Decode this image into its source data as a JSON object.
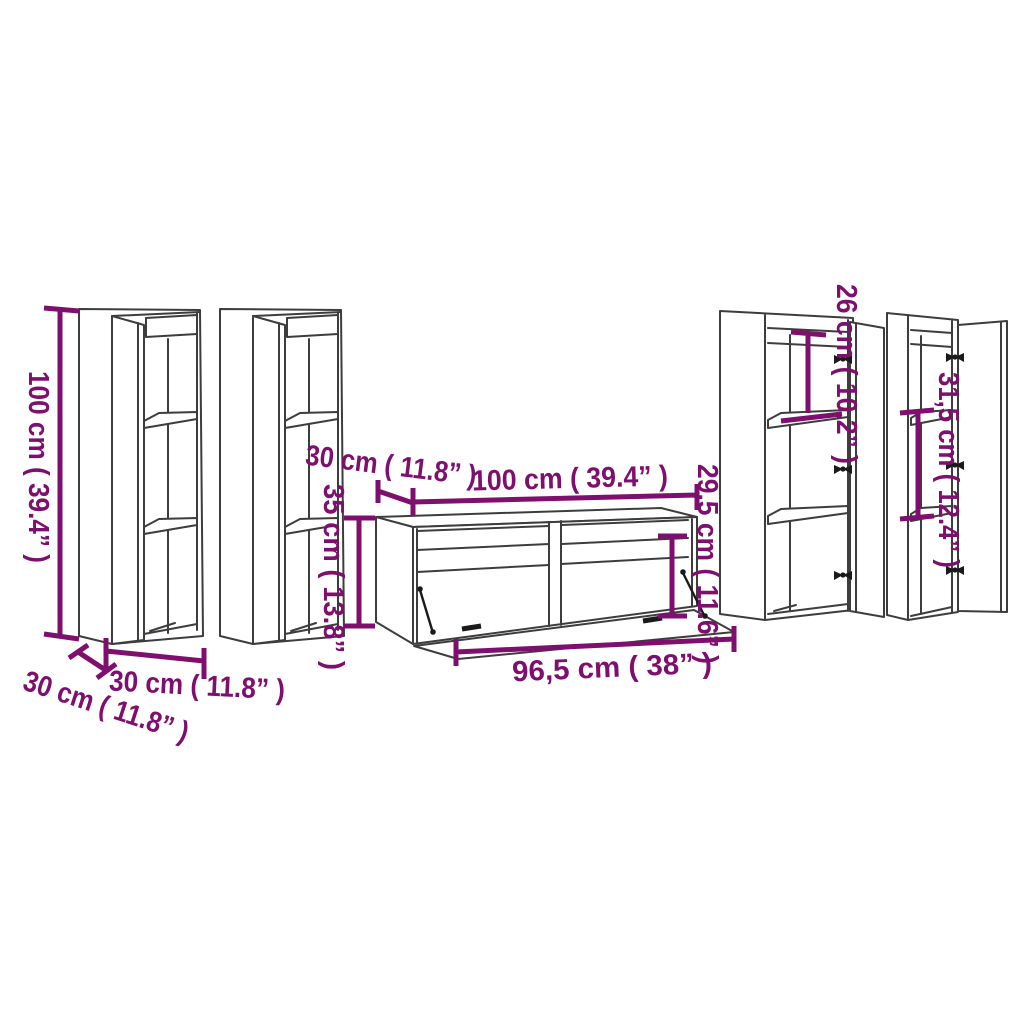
{
  "colors": {
    "accent": "#7e0f6e",
    "line": "#3d3d3d",
    "background": "#ffffff",
    "hardware": "#1a1a1a"
  },
  "figure": {
    "type": "furniture-dimension-diagram",
    "pieces": [
      "tall-wall-cabinet",
      "tall-wall-cabinet",
      "tv-stand-with-flap-door",
      "wall-cabinet-with-door",
      "wall-cabinet-with-door"
    ]
  },
  "labels": {
    "tall_height": "100 cm ( 39.4” )",
    "tall_width": "30 cm ( 11.8” )",
    "tall_depth": "30 cm ( 11.8” )",
    "tv_depth": "30 cm ( 11.8” )",
    "tv_width": "100 cm ( 39.4” )",
    "tv_height": "35 cm ( 13.8” )",
    "tv_inner_height": "29,5 cm ( 11.6” )",
    "tv_flap_width": "96,5 cm ( 38” )",
    "right_top_compartment": "26 cm ( 10.2” )",
    "right_middle_compartment": "31,5 cm ( 12.4” )"
  }
}
